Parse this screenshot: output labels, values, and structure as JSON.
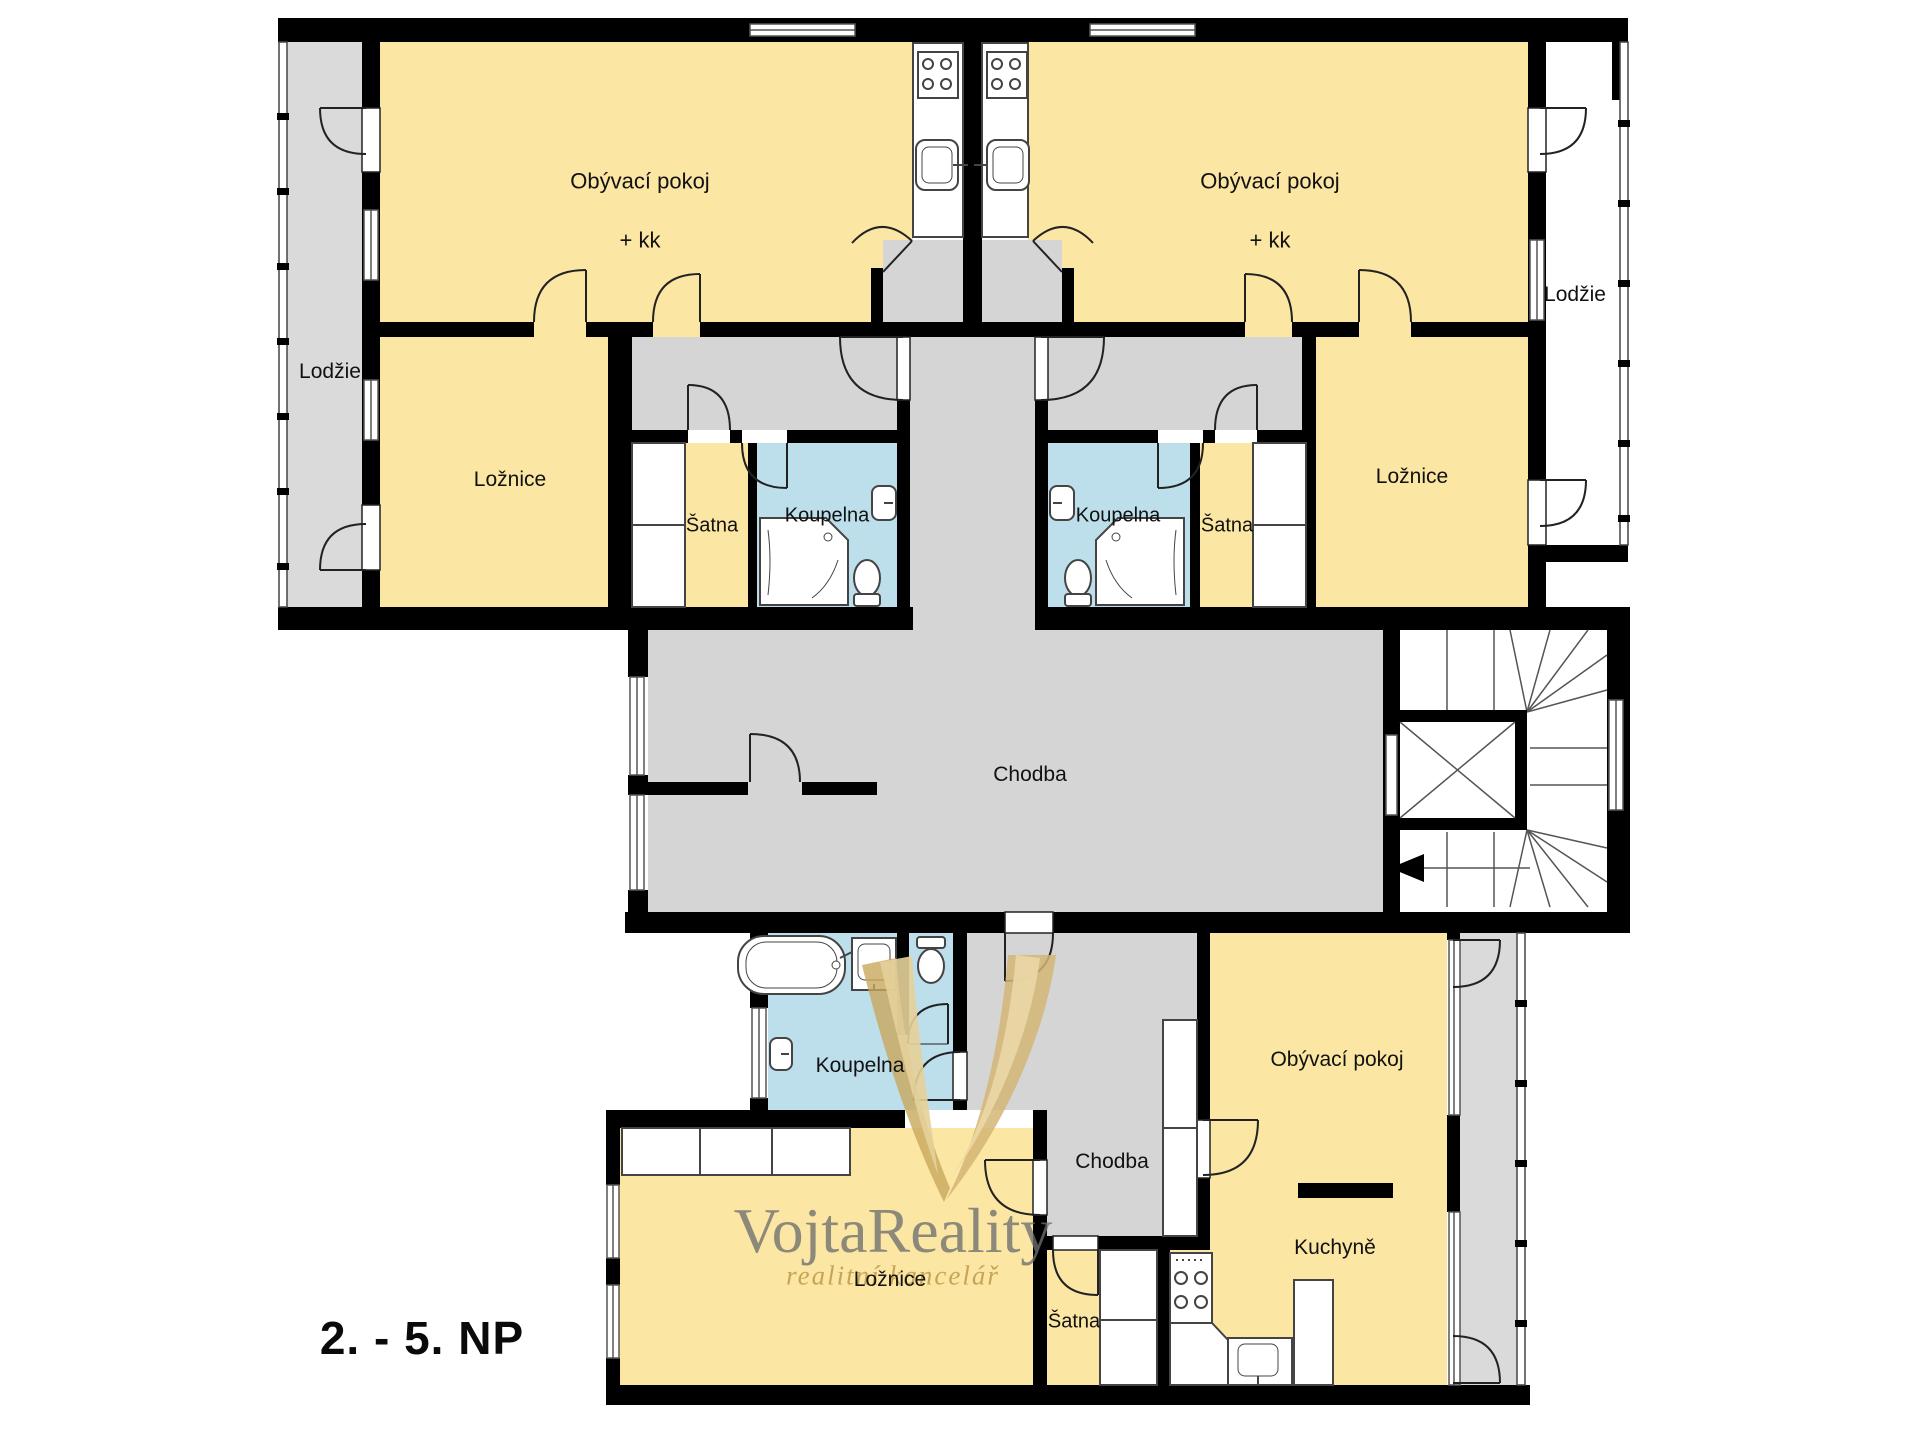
{
  "floor_label": "2. - 5. NP",
  "watermark": {
    "brand": "VojtaReality",
    "subtitle": "realitní kancelář"
  },
  "colors": {
    "room_yellow": "#FBE6A3",
    "corridor_gray": "#D5D5D5",
    "loggia_gray": "#DADADA",
    "bathroom_blue": "#BDDFEC",
    "wall_black": "#000000",
    "watermark_gold": "#C9A85C",
    "watermark_gray": "#6E6E6E"
  },
  "rooms": {
    "upper_left": {
      "living_room": "Obývací pokoj",
      "living_room_suffix": "+ kk",
      "loggia": "Lodžie",
      "bedroom": "Ložnice",
      "wardrobe": "Šatna",
      "bathroom": "Koupelna"
    },
    "upper_right": {
      "living_room": "Obývací pokoj",
      "living_room_suffix": "+ kk",
      "loggia": "Lodžie",
      "bedroom": "Ložnice",
      "wardrobe": "Šatna",
      "bathroom": "Koupelna"
    },
    "common": {
      "corridor": "Chodba"
    },
    "lower": {
      "bathroom": "Koupelna",
      "hallway": "Chodba",
      "bedroom": "Ložnice",
      "wardrobe": "Šatna",
      "living_room": "Obývací pokoj",
      "kitchen": "Kuchyně"
    }
  }
}
